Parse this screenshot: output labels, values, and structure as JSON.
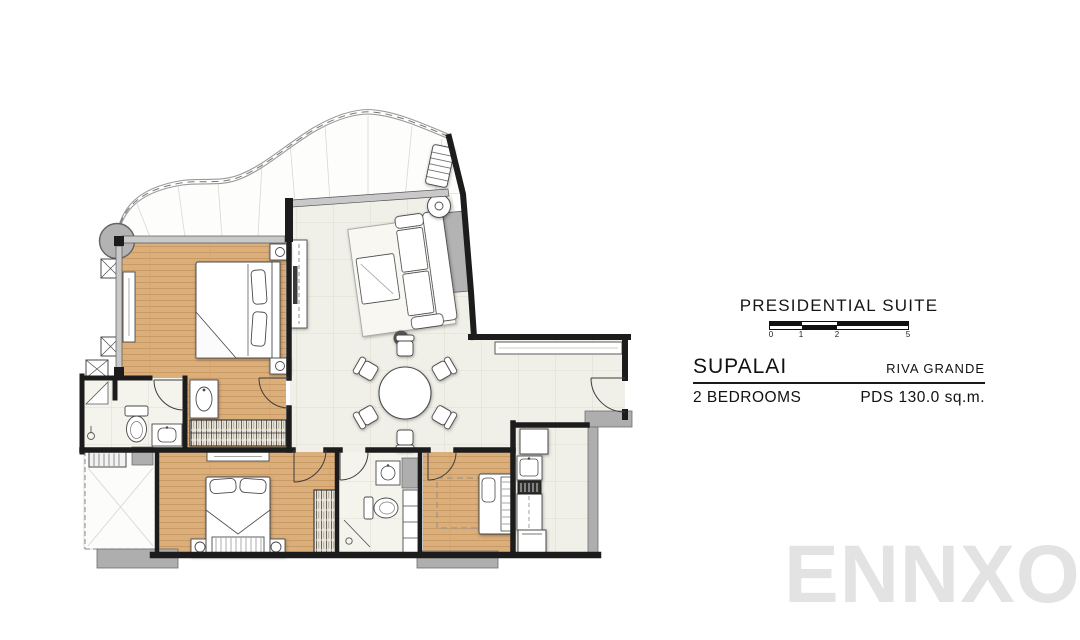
{
  "panel": {
    "title": "PRESIDENTIAL SUITE",
    "brand": "SUPALAI",
    "project": "RIVA GRANDE",
    "unit_type": "2 BEDROOMS",
    "area": "PDS 130.0 sq.m.",
    "scale": {
      "labels": [
        "0",
        "1",
        "2",
        "5"
      ]
    }
  },
  "watermark": "ENNXO",
  "plan": {
    "rooms": [
      "balcony-terrace",
      "master-bedroom",
      "master-bathroom",
      "living-dining-area",
      "entrance-hall",
      "kitchen",
      "bedroom-2",
      "bathroom-2",
      "bedroom-3",
      "service-balcony"
    ]
  },
  "colors": {
    "wood_floor": "#dcae79",
    "wood_line": "#c2945f",
    "tile_floor": "#f1f0e8",
    "tile_line": "#dbd8c9",
    "wall": "#1c1c1c",
    "gray_element": "#aeaeae",
    "watermark_color": "#e3e3e3"
  }
}
